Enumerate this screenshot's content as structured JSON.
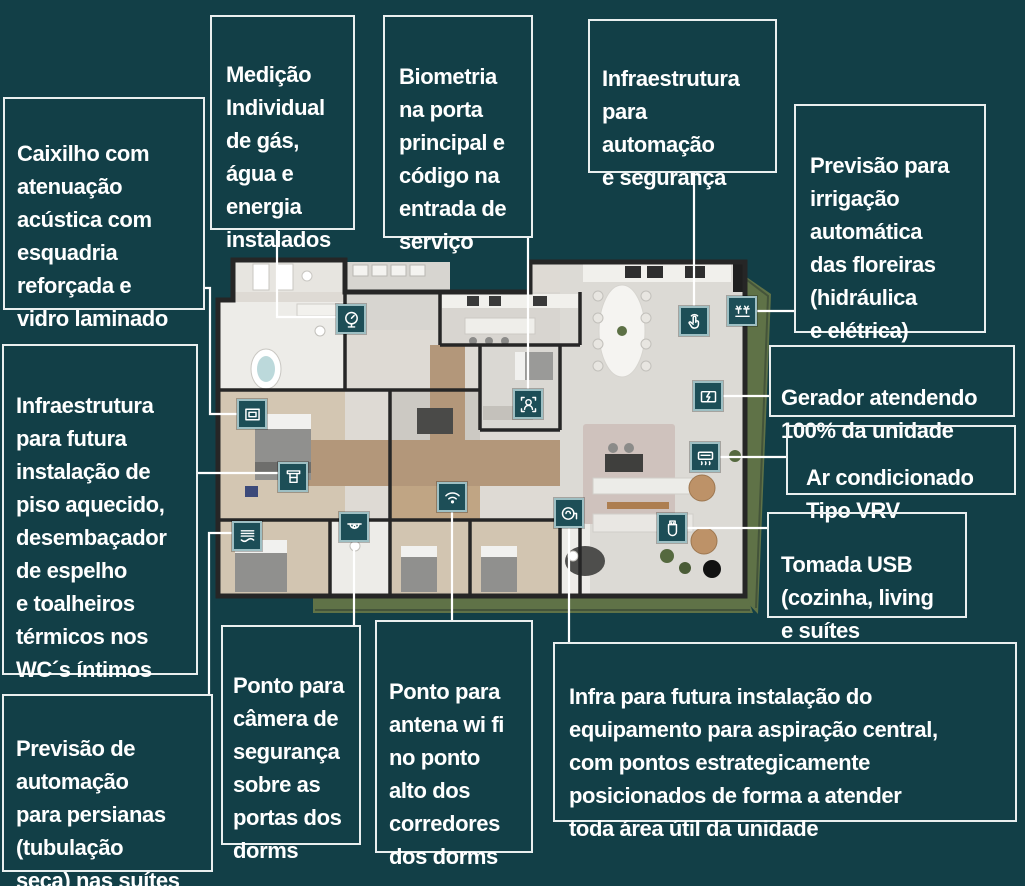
{
  "theme": {
    "background": "#123f47",
    "box_border": "#e9efef",
    "text_color": "#ffffff",
    "tile_fill": "#1d4e57",
    "tile_border": "#9ebfc3",
    "leader_line": "#ffffff",
    "plan_floor": "#dedad4",
    "plan_wall": "#262626",
    "plan_wood": "#b3977a",
    "plan_garden": "#5f7247"
  },
  "callouts": [
    {
      "id": "caixilho",
      "text": "Caixilho com\natenuação\nacústica com\nesquadria\nreforçada e\nvidro laminado"
    },
    {
      "id": "medicao",
      "text": "Medição\nIndividual\nde gás,\nágua e\nenergia\ninstalados"
    },
    {
      "id": "biometria",
      "text": "Biometria\nna porta\nprincipal e\ncódigo na\nentrada de\nserviço"
    },
    {
      "id": "automacao",
      "text": "Infraestrutura\npara\nautomação\ne segurança"
    },
    {
      "id": "irrigacao",
      "text": "Previsão para\nirrigação\nautomática\ndas floreiras\n(hidráulica\ne elétrica)"
    },
    {
      "id": "gerador",
      "text": "Gerador atendendo\n100% da unidade"
    },
    {
      "id": "ar_condicionado",
      "text": "Ar condicionado\nTipo VRV"
    },
    {
      "id": "tomada_usb",
      "text": "Tomada USB\n(cozinha, living\ne suítes"
    },
    {
      "id": "piso_aquecido",
      "text": "Infraestrutura\npara futura\ninstalação de\npiso aquecido,\ndesembaçador\nde espelho\ne toalheiros\ntérmicos nos\nWC´s íntimos"
    },
    {
      "id": "persianas",
      "text": "Previsão de\nautomação\npara persianas\n(tubulação\nseca) nas suítes"
    },
    {
      "id": "camera",
      "text": "Ponto para\ncâmera de\nsegurança\nsobre as\nportas dos\ndorms"
    },
    {
      "id": "wifi",
      "text": "Ponto para\nantena wi fi\nno ponto\nalto dos\ncorredores\ndos dorms"
    },
    {
      "id": "aspiracao",
      "text": "Infra para futura instalação do\nequipamento para aspiração central,\ncom pontos estrategicamente\nposicionados de forma a atender\ntoda área útil da unidade"
    }
  ],
  "plan_markers": [
    {
      "icon": "utility-meter-icon",
      "feature": "medicao"
    },
    {
      "icon": "biometric-access-icon",
      "feature": "biometria"
    },
    {
      "icon": "home-automation-touch-icon",
      "feature": "automacao"
    },
    {
      "icon": "irrigation-sprinkler-icon",
      "feature": "irrigacao"
    },
    {
      "icon": "generator-icon",
      "feature": "gerador"
    },
    {
      "icon": "vrv-air-conditioning-icon",
      "feature": "ar_condicionado"
    },
    {
      "icon": "usb-outlet-icon",
      "feature": "tomada_usb"
    },
    {
      "icon": "central-vacuum-icon",
      "feature": "aspiracao"
    },
    {
      "icon": "wifi-antenna-icon",
      "feature": "wifi"
    },
    {
      "icon": "security-camera-icon",
      "feature": "camera"
    },
    {
      "icon": "motorized-blinds-icon",
      "feature": "persianas"
    },
    {
      "icon": "heated-towel-rail-icon",
      "feature": "piso_aquecido"
    },
    {
      "icon": "acoustic-window-icon",
      "feature": "caixilho"
    }
  ]
}
